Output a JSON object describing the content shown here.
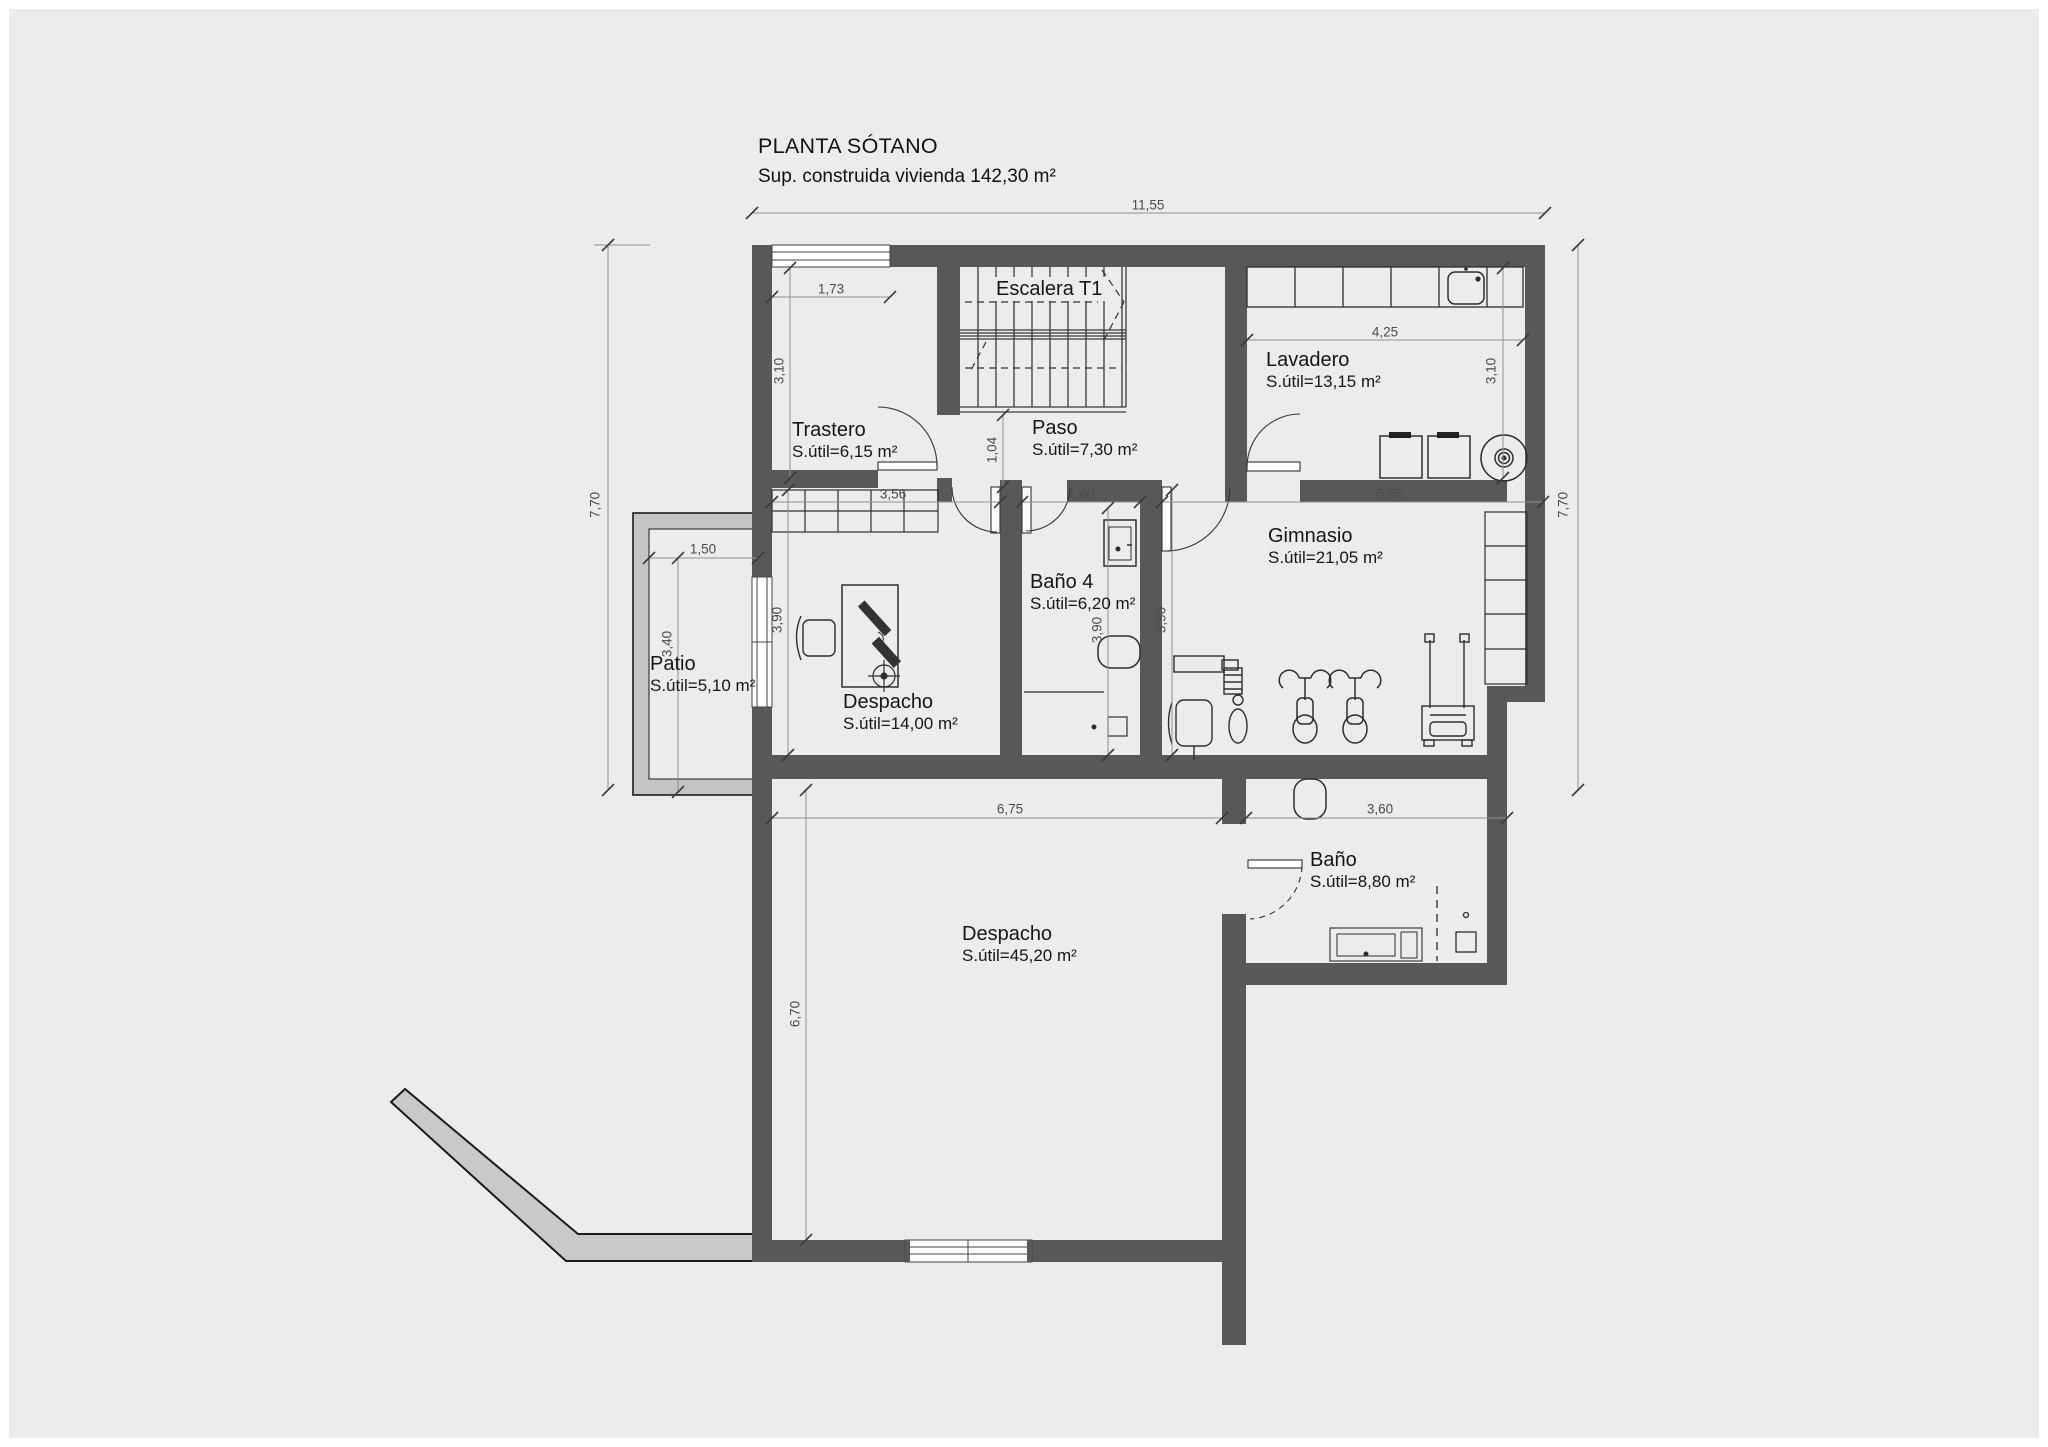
{
  "title": {
    "line1": "PLANTA SÓTANO",
    "line2": "Sup. construida vivienda 142,30 m²"
  },
  "rooms": [
    {
      "name": "Escalera T1",
      "area": ""
    },
    {
      "name": "Lavadero",
      "area": "S.útil=13,15 m²"
    },
    {
      "name": "Trastero",
      "area": "S.útil=6,15 m²"
    },
    {
      "name": "Paso",
      "area": "S.útil=7,30 m²"
    },
    {
      "name": "Baño 4",
      "area": "S.útil=6,20 m²"
    },
    {
      "name": "Gimnasio",
      "area": "S.útil=21,05 m²"
    },
    {
      "name": "Despacho",
      "area": "S.útil=14,00 m²"
    },
    {
      "name": "Patio",
      "area": "S.útil=5,10 m²"
    },
    {
      "name": "Baño",
      "area": "S.útil=8,80 m²"
    },
    {
      "name": "Despacho",
      "area": "S.útil=45,20 m²"
    }
  ],
  "dimensions": {
    "overall_width": "11,55",
    "overall_height_left": "7,70",
    "overall_height_right": "7,70",
    "trastero_window": "1,73",
    "trastero_height": "3,10",
    "lavadero_width": "4,25",
    "lavadero_height": "3,10",
    "paso_height": "1,04",
    "despacho1_width": "3,56",
    "bano4_width": "1,60",
    "gimnasio_width": "5,55",
    "despacho1_height": "3,90",
    "bano4_height": "3,90",
    "gimnasio_height": "3,90",
    "patio_width": "1,50",
    "patio_height": "3,40",
    "despacho2_width": "6,75",
    "bano_width": "3,60",
    "despacho2_height": "6,70"
  },
  "colors": {
    "background": "#ececec",
    "wall": "#58585a",
    "patio_wall": "#c4c4c4",
    "line": "#2e2e2e",
    "dimension": "#4c4c4c"
  }
}
